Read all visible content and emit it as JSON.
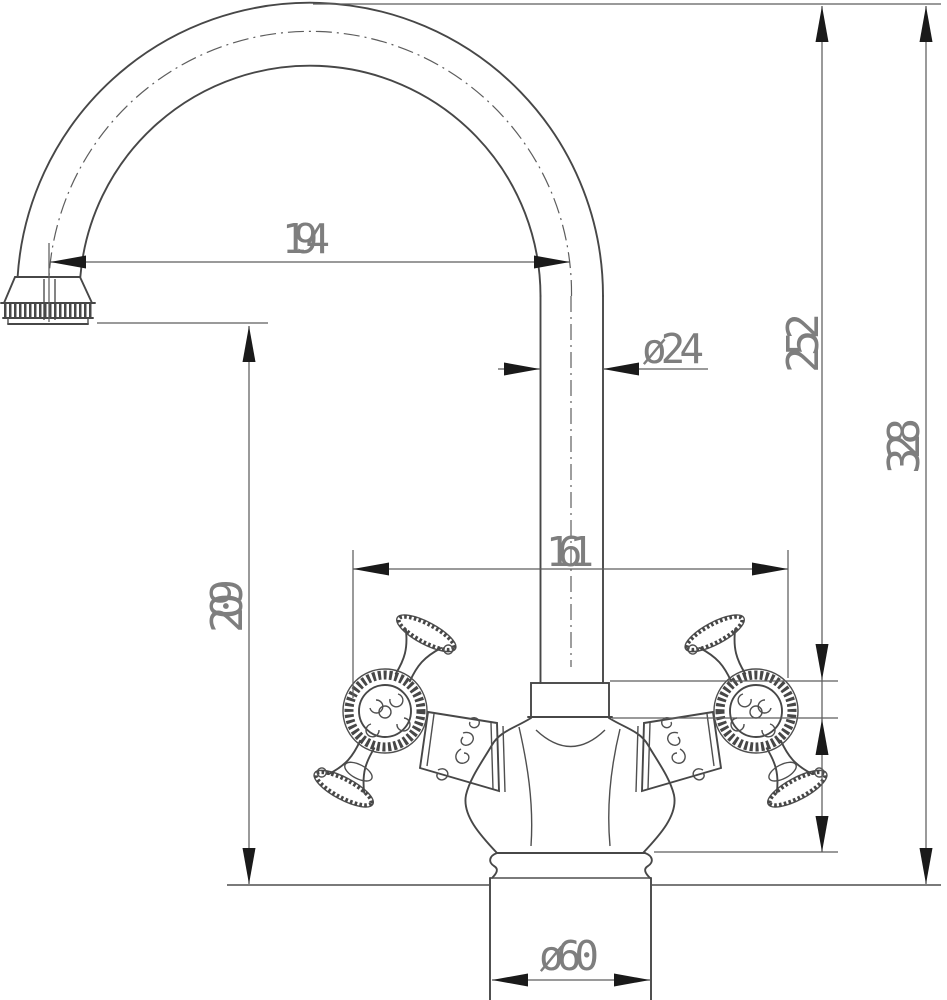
{
  "drawing": {
    "title": "two-handle gooseneck faucet dimensional drawing",
    "dimensions": {
      "spout_reach": "194",
      "spout_tube_diameter": "ø24",
      "spout_top_height": "252",
      "overall_height": "328",
      "handle_span": "161",
      "outlet_height": "209",
      "base_diameter": "ø60"
    },
    "colors": {
      "background": "#ffffff",
      "line": "#474747",
      "dimension_line": "#5d5d5d",
      "arrow": "#1a1a1a",
      "label_text": "#7e7e7e"
    }
  }
}
